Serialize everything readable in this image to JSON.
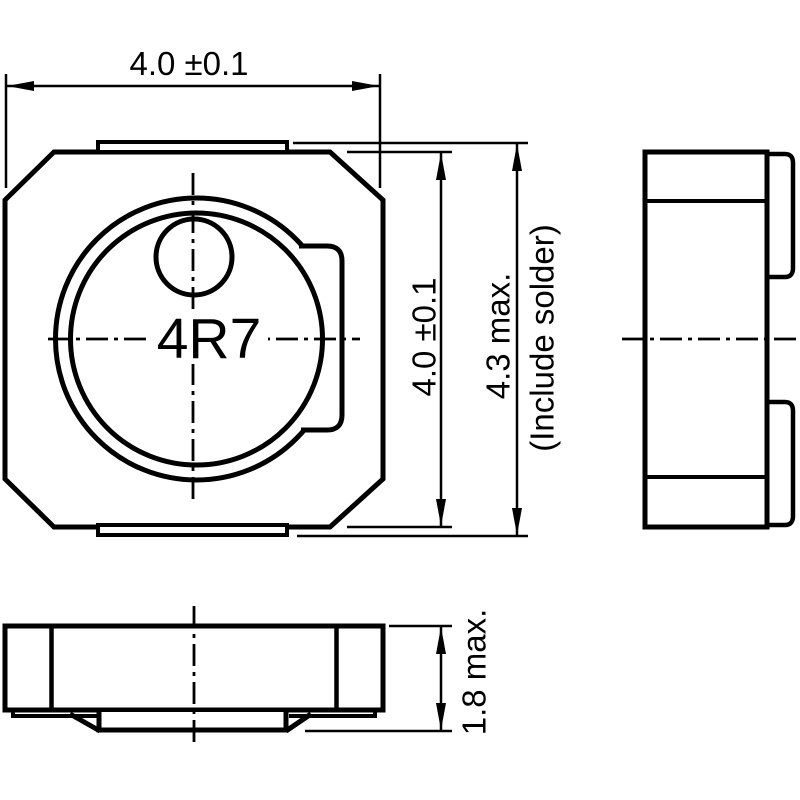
{
  "drawing": {
    "type": "component-dimension-drawing",
    "component_marking": "4R7",
    "dimensions": {
      "top_width": "4.0 ±0.1",
      "body_height": "4.0 ±0.1",
      "height_with_solder": "4.3 max.",
      "height_with_solder_note": "(Include solder)",
      "thickness": "1.8 max."
    }
  },
  "colors": {
    "line": "#000000",
    "background": "#ffffff"
  }
}
